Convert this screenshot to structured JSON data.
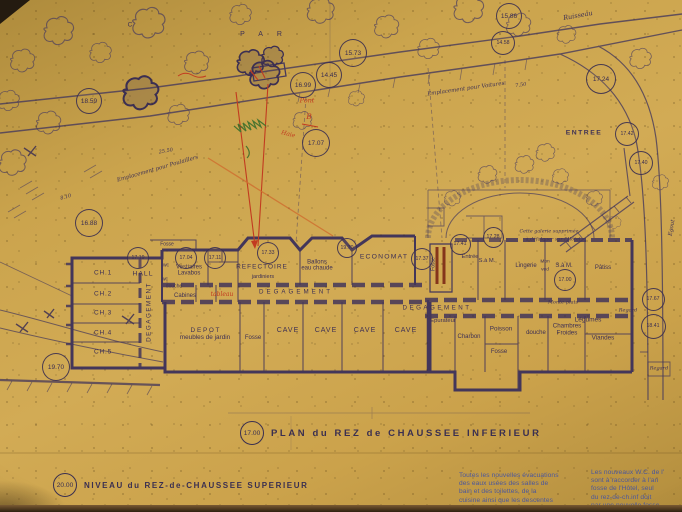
{
  "palette": {
    "paper": "#d2ab55",
    "ink": "#3e3054",
    "ink_soft": "#564868",
    "red": "#c23b20",
    "maroon": "#7c2815",
    "orange": "#cf7030",
    "green": "#49742f",
    "blue": "#4a569c"
  },
  "titles": {
    "plan_elev": "17.00",
    "plan": "PLAN du REZ de CHAUSSEE INFERIEUR",
    "niveau_elev": "20.00",
    "niveau": "NIVEAU du REZ-de-CHAUSSEE SUPERIEUR"
  },
  "notes_blue": {
    "col1": [
      "Toutes les nouvelles évacuations",
      "des eaux usées des salles de",
      "bain et des toilettes, de la",
      "cuisine ainsi que les descentes",
      "de l'aile Est"
    ],
    "col2": [
      "Les nouveaux W.C. de l'",
      "sont à raccorder à l'an",
      "fosse de l'Hôtel, seul",
      "du rez-de-ch.inf doit",
      "par une nouvelle fosse"
    ]
  },
  "elevations": [
    {
      "n": "elevation-18-59",
      "v": "18.59",
      "x": 88,
      "y": 100,
      "d": 24
    },
    {
      "n": "elevation-15-73",
      "v": "15.73",
      "x": 352,
      "y": 52,
      "d": 26
    },
    {
      "n": "elevation-14-45",
      "v": "14.45",
      "x": 328,
      "y": 74,
      "d": 24
    },
    {
      "n": "elevation-16-99",
      "v": "16.99",
      "x": 302,
      "y": 84,
      "d": 24
    },
    {
      "n": "elevation-17-07",
      "v": "17.07",
      "x": 315,
      "y": 142,
      "d": 26
    },
    {
      "n": "elevation-15-86",
      "v": "15.86",
      "x": 508,
      "y": 15,
      "d": 24
    },
    {
      "n": "elevation-14-58",
      "v": "14.58",
      "x": 502,
      "y": 42,
      "d": 22
    },
    {
      "n": "elevation-17-24",
      "v": "17.24",
      "x": 600,
      "y": 78,
      "d": 28
    },
    {
      "n": "elevation-17-42",
      "v": "17.42",
      "x": 626,
      "y": 133,
      "d": 22
    },
    {
      "n": "elevation-17-40",
      "v": "17.40",
      "x": 640,
      "y": 162,
      "d": 22
    },
    {
      "n": "elevation-16-88",
      "v": "16.88",
      "x": 88,
      "y": 222,
      "d": 26
    },
    {
      "n": "elevation-19-70-a",
      "v": "19.70",
      "x": 55,
      "y": 366,
      "d": 26
    },
    {
      "n": "elevation-17-19",
      "v": "17.19",
      "x": 137,
      "y": 257,
      "d": 20
    },
    {
      "n": "elevation-17-04",
      "v": "17.04",
      "x": 185,
      "y": 257,
      "d": 20
    },
    {
      "n": "elevation-17-11",
      "v": "17.11",
      "x": 214,
      "y": 257,
      "d": 20
    },
    {
      "n": "elevation-17-33",
      "v": "17.33",
      "x": 267,
      "y": 252,
      "d": 20
    },
    {
      "n": "elevation-19-70-b",
      "v": "19.70",
      "x": 346,
      "y": 247,
      "d": 18
    },
    {
      "n": "elevation-17-37",
      "v": "17.37",
      "x": 421,
      "y": 258,
      "d": 20
    },
    {
      "n": "elevation-17-41",
      "v": "17.41",
      "x": 459,
      "y": 243,
      "d": 19
    },
    {
      "n": "elevation-17-28",
      "v": "17.28",
      "x": 492,
      "y": 236,
      "d": 19
    },
    {
      "n": "elevation-17-00",
      "v": "17.00",
      "x": 564,
      "y": 279,
      "d": 20
    },
    {
      "n": "elevation-17-67",
      "v": "17.67",
      "x": 652,
      "y": 298,
      "d": 21
    },
    {
      "n": "elevation-18-41",
      "v": "18.41",
      "x": 652,
      "y": 325,
      "d": 23
    }
  ],
  "labels": [
    {
      "n": "room-ch1",
      "t": "CH.1",
      "x": 103,
      "y": 273,
      "s": 6.5,
      "ls": 0.8
    },
    {
      "n": "room-ch2",
      "t": "CH.2",
      "x": 103,
      "y": 294,
      "s": 6.5,
      "ls": 0.8
    },
    {
      "n": "room-ch3",
      "t": "CH.3",
      "x": 103,
      "y": 313,
      "s": 6.5,
      "ls": 0.8
    },
    {
      "n": "room-ch4",
      "t": "CH.4",
      "x": 103,
      "y": 333,
      "s": 6.5,
      "ls": 0.8
    },
    {
      "n": "room-ch5",
      "t": "CH.5",
      "x": 103,
      "y": 352,
      "s": 6.5,
      "ls": 0.8
    },
    {
      "n": "corridor-left",
      "t": "DEGAGEMENT",
      "x": 150,
      "y": 312,
      "s": 6.3,
      "ls": 1.5,
      "r": -90
    },
    {
      "n": "room-hall",
      "t": "HALL",
      "x": 143,
      "y": 274,
      "s": 6.8,
      "ls": 1
    },
    {
      "n": "room-vestiaires",
      "t": "Vestiaires\nLavabos",
      "x": 189,
      "y": 271,
      "s": 6
    },
    {
      "n": "room-wc-1",
      "t": "wc",
      "x": 166,
      "y": 266,
      "s": 5
    },
    {
      "n": "room-wc-2",
      "t": "wc",
      "x": 165,
      "y": 280,
      "s": 5
    },
    {
      "n": "room-douche-1",
      "t": "douche",
      "x": 174,
      "y": 287,
      "s": 5
    },
    {
      "n": "room-cabines",
      "t": "Cabines",
      "x": 185,
      "y": 296,
      "s": 6
    },
    {
      "n": "room-fosse-terrace",
      "t": "Fosse",
      "x": 167,
      "y": 245,
      "s": 5
    },
    {
      "n": "room-refectoire",
      "t": "REFECTOIRE",
      "x": 262,
      "y": 267,
      "s": 6.5,
      "ls": 1
    },
    {
      "n": "room-jardiniers",
      "t": "jardiniers",
      "x": 263,
      "y": 278,
      "s": 5.5
    },
    {
      "n": "room-ballons",
      "t": "Ballons\neau chaude",
      "x": 317,
      "y": 266,
      "s": 6
    },
    {
      "n": "room-economat",
      "t": "ECONOMAT",
      "x": 384,
      "y": 257,
      "s": 6.8,
      "ls": 1.2
    },
    {
      "n": "corridor-center",
      "t": "DEGAGEMENT",
      "x": 296,
      "y": 293,
      "s": 6.2,
      "ls": 3
    },
    {
      "n": "corridor-right",
      "t": "DEGAGEMENT",
      "x": 437,
      "y": 309,
      "s": 6.2,
      "ls": 2.5
    },
    {
      "n": "room-depot",
      "t": "D E P O T\nmeubles de jardin",
      "x": 205,
      "y": 335,
      "s": 6.4
    },
    {
      "n": "room-fosse-center",
      "t": "Fosse",
      "x": 253,
      "y": 338,
      "s": 6
    },
    {
      "n": "room-cave-1",
      "t": "CAVE",
      "x": 288,
      "y": 331,
      "s": 7,
      "ls": 1
    },
    {
      "n": "room-cave-2",
      "t": "CAVE",
      "x": 326,
      "y": 331,
      "s": 7,
      "ls": 1
    },
    {
      "n": "room-cave-3",
      "t": "CAVE",
      "x": 365,
      "y": 331,
      "s": 7,
      "ls": 1
    },
    {
      "n": "room-cave-4",
      "t": "CAVE",
      "x": 406,
      "y": 331,
      "s": 7,
      "ls": 1
    },
    {
      "n": "room-epurateur",
      "t": "Epurateur",
      "x": 443,
      "y": 321,
      "s": 5.8
    },
    {
      "n": "room-charbon",
      "t": "Charbon",
      "x": 469,
      "y": 337,
      "s": 6
    },
    {
      "n": "room-poisson",
      "t": "Poisson",
      "x": 501,
      "y": 330,
      "s": 6.3
    },
    {
      "n": "room-fosse-right",
      "t": "Fosse",
      "x": 499,
      "y": 352,
      "s": 6
    },
    {
      "n": "room-douche-2",
      "t": "douche",
      "x": 536,
      "y": 333,
      "s": 6
    },
    {
      "n": "room-chambres-froides",
      "t": "Chambres\nFroides",
      "x": 567,
      "y": 330,
      "s": 6.2
    },
    {
      "n": "room-legumes",
      "t": "Légumes",
      "x": 588,
      "y": 320,
      "s": 6.5
    },
    {
      "n": "room-viandes",
      "t": "Viandes",
      "x": 603,
      "y": 339,
      "s": 6.3
    },
    {
      "n": "room-entree",
      "t": "Entrée",
      "x": 470,
      "y": 257,
      "s": 5.8
    },
    {
      "n": "room-sam-1",
      "t": "S.à M.",
      "x": 487,
      "y": 261,
      "s": 5.8
    },
    {
      "n": "room-lingerie",
      "t": "Lingerie",
      "x": 526,
      "y": 266,
      "s": 6
    },
    {
      "n": "room-mon",
      "t": "Mon",
      "x": 545,
      "y": 262,
      "s": 4.8
    },
    {
      "n": "room-ved",
      "t": "ved",
      "x": 545,
      "y": 270,
      "s": 4.8
    },
    {
      "n": "room-sam-2",
      "t": "S.à M.",
      "x": 564,
      "y": 266,
      "s": 6
    },
    {
      "n": "room-patiss",
      "t": "Pâtiss",
      "x": 603,
      "y": 268,
      "s": 6
    },
    {
      "n": "monte-plats-note",
      "t": "Monte-plats",
      "x": 563,
      "y": 303,
      "s": 5,
      "cls": "script"
    },
    {
      "n": "room-fosse-entrance",
      "t": "Fosse",
      "x": 434,
      "y": 264,
      "s": 5,
      "r": -90
    },
    {
      "n": "entree-upper",
      "t": "ENTREE",
      "x": 584,
      "y": 133,
      "s": 6.8,
      "ls": 1.5,
      "b": 1
    },
    {
      "n": "egout-label",
      "t": "Egout",
      "x": 673,
      "y": 228,
      "s": 5.5,
      "r": -80,
      "cls": "script"
    },
    {
      "n": "regard-label-1",
      "t": "Regard",
      "x": 628,
      "y": 311,
      "s": 5,
      "cls": "script"
    },
    {
      "n": "regard-label-2",
      "t": "Regard",
      "x": 659,
      "y": 369,
      "s": 5,
      "cls": "script"
    },
    {
      "n": "ruisseau-label",
      "t": "Ruisseau",
      "x": 578,
      "y": 16,
      "s": 6.5,
      "r": -10,
      "cls": "script"
    },
    {
      "n": "parc-letters",
      "t": "PAR",
      "x": 268,
      "y": 35,
      "s": 7,
      "ls": 14
    },
    {
      "n": "parc-letter-c",
      "t": "C",
      "x": 130,
      "y": 25,
      "s": 6.5
    },
    {
      "n": "emplacement-voitures",
      "t": "Emplacement pour Voitures",
      "x": 466,
      "y": 90,
      "s": 5.5,
      "r": -8,
      "cls": "script"
    },
    {
      "n": "emplacement-poulaillers",
      "t": "Emplacement pour Poulaillers",
      "x": 158,
      "y": 170,
      "s": 5.5,
      "r": -16,
      "cls": "script"
    },
    {
      "n": "dim-25-50",
      "t": "25.50",
      "x": 166,
      "y": 152,
      "s": 5,
      "r": -10,
      "cls": "script"
    },
    {
      "n": "dim-7-50",
      "t": "7.50",
      "x": 521,
      "y": 86,
      "s": 5,
      "r": -8,
      "cls": "script"
    },
    {
      "n": "dim-8-10",
      "t": "8.10",
      "x": 66,
      "y": 198,
      "s": 5,
      "r": -15,
      "cls": "script"
    },
    {
      "n": "galerie-note",
      "t": "Cette galerie supprimée",
      "x": 549,
      "y": 232,
      "s": 4.8,
      "cls": "script"
    },
    {
      "n": "defalquer-note",
      "t": "à défalquer sur l'Hôtel",
      "x": 553,
      "y": 240,
      "s": 4.8,
      "cls": "script"
    },
    {
      "n": "pont-note",
      "t": "Pont",
      "x": 307,
      "y": 101,
      "s": 6.5,
      "c": "red",
      "cls": "script"
    },
    {
      "n": "pont-b-note",
      "t": "B",
      "x": 309,
      "y": 117,
      "s": 7.5,
      "c": "red",
      "cls": "script"
    },
    {
      "n": "haie-note",
      "t": "Haie",
      "x": 288,
      "y": 135,
      "s": 6,
      "r": 14,
      "c": "red",
      "cls": "script"
    },
    {
      "n": "tableau-note",
      "t": "tableau",
      "x": 222,
      "y": 295,
      "s": 6,
      "c": "red",
      "cls": "script"
    }
  ]
}
